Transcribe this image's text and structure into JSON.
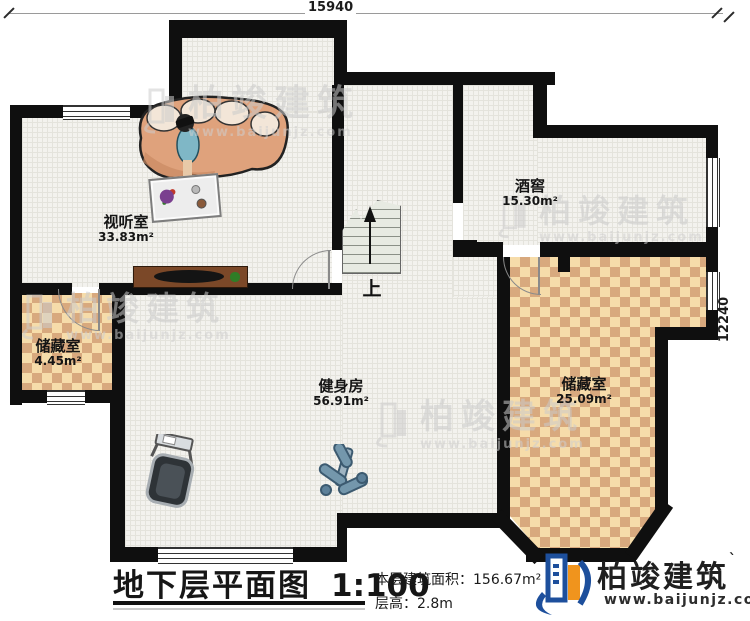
{
  "title_block": {
    "title": "地下层平面图",
    "scale": "1:100",
    "area_label": "本层建筑面积：",
    "area_value": "156.67m²",
    "height_label": "层高：",
    "height_value": "2.8m"
  },
  "dimensions": {
    "top": "15940",
    "right": "12240"
  },
  "rooms": {
    "media": {
      "name": "视听室",
      "area": "33.83m²"
    },
    "wine": {
      "name": "酒窖",
      "area": "15.30m²"
    },
    "storage_small": {
      "name": "储藏室",
      "area": "4.45m²"
    },
    "gym": {
      "name": "健身房",
      "area": "56.91m²"
    },
    "storage_large": {
      "name": "储藏室",
      "area": "25.09m²"
    }
  },
  "stairs": {
    "up_label": "上"
  },
  "brand": {
    "name": "柏竣建筑",
    "tick": "`",
    "website": "www.baijunjz.com"
  },
  "watermark": {
    "name": "柏竣建筑",
    "website": "www.baijunjz.com"
  },
  "colors": {
    "wall": "#0f0f0f",
    "floor": "#f3f2ee",
    "checker_light": "#f6dcaa",
    "checker_dark": "#d8a97e",
    "brand_blue": "#1d4f9c",
    "brand_orange": "#f0941d"
  }
}
